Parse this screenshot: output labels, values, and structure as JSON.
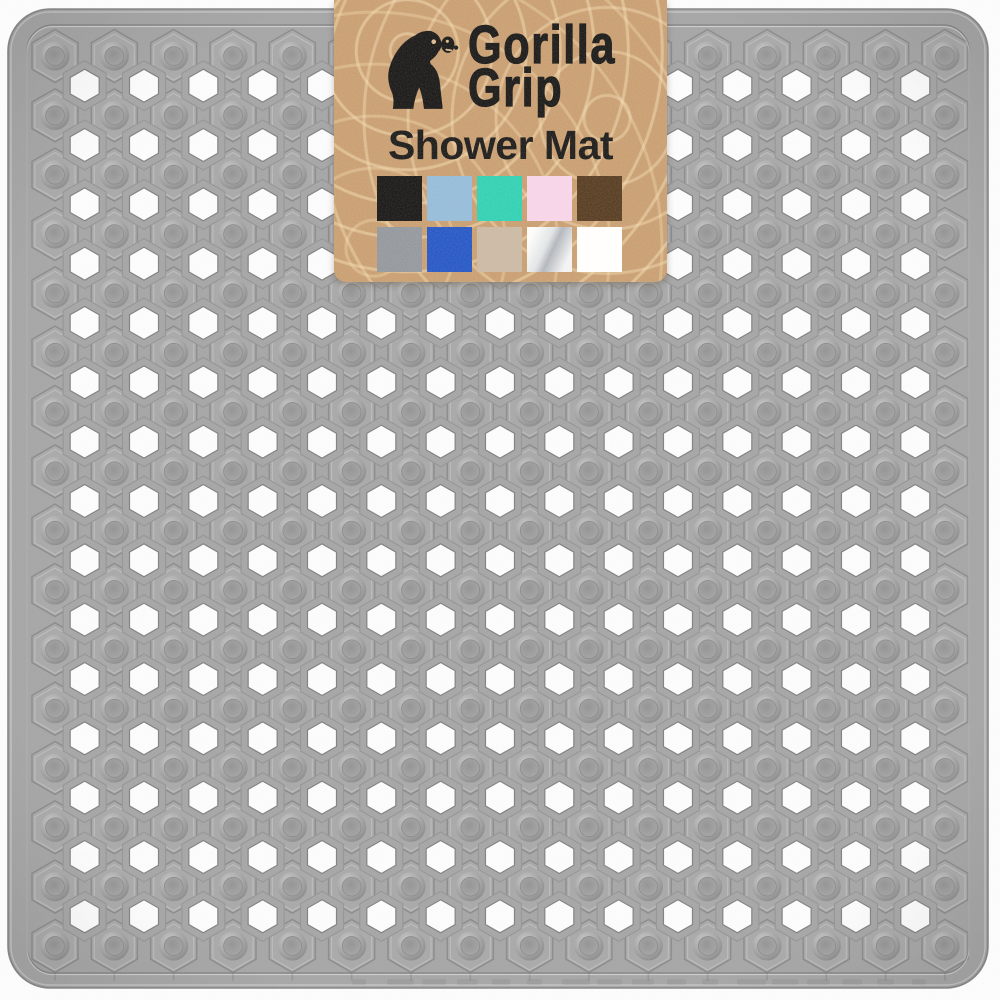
{
  "product": {
    "brand_line1": "Gorilla",
    "brand_line2": "Grip",
    "title": "Shower Mat"
  },
  "label": {
    "background_color": "#c69a6c",
    "text_color": "#101010",
    "logo": "gorilla-silhouette",
    "swatches": [
      {
        "name": "black",
        "color": "#0d0d0d"
      },
      {
        "name": "light-blue",
        "color": "#8fb9da"
      },
      {
        "name": "turquoise",
        "color": "#26cfb2"
      },
      {
        "name": "light-pink",
        "color": "#f8d3ea"
      },
      {
        "name": "brown",
        "color": "#4e3318"
      },
      {
        "name": "gray",
        "color": "#8e939a"
      },
      {
        "name": "royal-blue",
        "color": "#1a4fc5"
      },
      {
        "name": "beige",
        "color": "#c8b6a1"
      },
      {
        "name": "silver",
        "color": "linear-gradient(115deg,#fdfdfd 12%,#dfe3e7 42%,#adb3bb 55%,#f2f3f5 85%)"
      },
      {
        "name": "white",
        "color": "#ffffff"
      }
    ]
  },
  "mat": {
    "base_color": "#a9a9a9",
    "hole_color": "#ffffff",
    "pattern": {
      "suction_rows": 16,
      "suction_cols": 16,
      "hole_rows": 15,
      "hole_cols": 15
    }
  },
  "background_color": "#ffffff"
}
